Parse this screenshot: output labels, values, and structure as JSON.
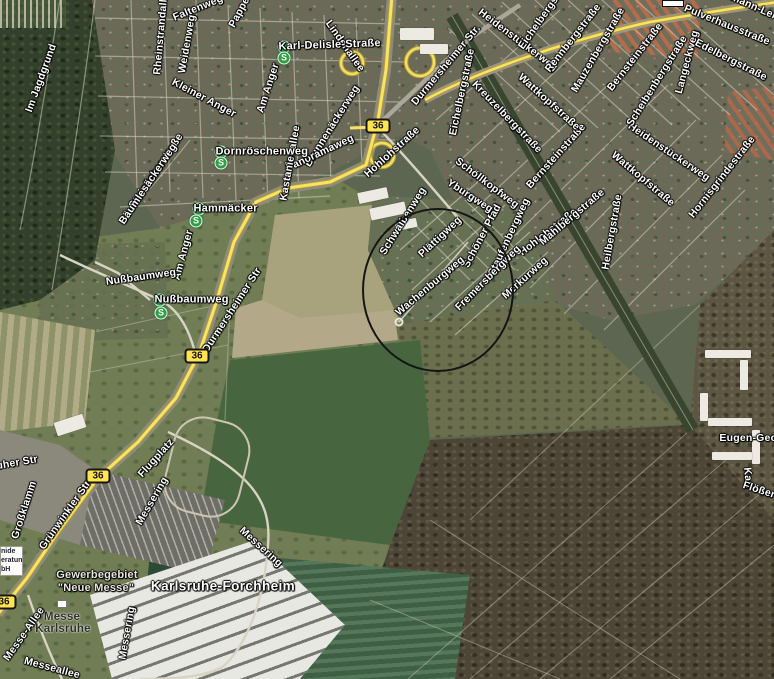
{
  "map": {
    "view_type": "satellite",
    "town_label": "Karlsruhe-Forchheim",
    "route_badge": {
      "label": "36"
    },
    "station_icon": {
      "letter": "S",
      "color": "#2f9e41"
    },
    "accent_colors": {
      "route_yellow": "#f6e468",
      "annotation_black": "#151515",
      "label_white": "#ffffff"
    }
  },
  "labels": [
    {
      "t": "Im Jagdgrund",
      "x": 41,
      "y": 78,
      "r": -70
    },
    {
      "t": "Rheinstrandallee",
      "x": 161,
      "y": 31,
      "r": -85
    },
    {
      "t": "Faltenweg",
      "x": 198,
      "y": 8,
      "r": -22
    },
    {
      "t": "Weidenweg",
      "x": 187,
      "y": 44,
      "r": -80
    },
    {
      "t": "Pappel",
      "x": 240,
      "y": 11,
      "r": -62
    },
    {
      "t": "Karl-Delisle-Straße",
      "x": 284,
      "y": 47,
      "r": -2,
      "s": "station"
    },
    {
      "t": "Lindenallee",
      "x": 345,
      "y": 46,
      "r": 55
    },
    {
      "t": "Kleiner Anger",
      "x": 204,
      "y": 98,
      "r": 28
    },
    {
      "t": "Dornröschenweg",
      "x": 221,
      "y": 152,
      "r": 0,
      "s": "station"
    },
    {
      "t": "Steinäckerstraße",
      "x": 156,
      "y": 171,
      "r": -56
    },
    {
      "t": "Bäumlesäckerweg",
      "x": 148,
      "y": 184,
      "r": -56
    },
    {
      "t": "Am Anger",
      "x": 268,
      "y": 88,
      "r": -72
    },
    {
      "t": "Brunnenäckerweg",
      "x": 332,
      "y": 126,
      "r": -58
    },
    {
      "t": "Panoramaweg",
      "x": 320,
      "y": 153,
      "r": -25
    },
    {
      "t": "Kastanienallee",
      "x": 290,
      "y": 163,
      "r": -80
    },
    {
      "t": "Hammäcker",
      "x": 199,
      "y": 209,
      "r": 0,
      "s": "station"
    },
    {
      "t": "Am Anger",
      "x": 183,
      "y": 255,
      "r": -75
    },
    {
      "t": "Nußbaumweg",
      "x": 141,
      "y": 277,
      "r": -8
    },
    {
      "t": "Nußbaumweg",
      "x": 160,
      "y": 300,
      "r": 0,
      "s": "station"
    },
    {
      "t": "Durmersheimer Str.",
      "x": 446,
      "y": 65,
      "r": -50
    },
    {
      "t": "Durmersheimer Str",
      "x": 232,
      "y": 310,
      "r": -57
    },
    {
      "t": "Hohlohstraße",
      "x": 392,
      "y": 152,
      "r": -42
    },
    {
      "t": "Hohlohstraße",
      "x": 548,
      "y": 232,
      "r": -38
    },
    {
      "t": "Heidenstückerweg",
      "x": 518,
      "y": 40,
      "r": 37
    },
    {
      "t": "Heidenstückerweg",
      "x": 669,
      "y": 152,
      "r": 34
    },
    {
      "t": "Eichelbergstraße",
      "x": 546,
      "y": 12,
      "r": -55
    },
    {
      "t": "Eichelbergstraße",
      "x": 462,
      "y": 92,
      "r": -78
    },
    {
      "t": "Kreuzelbergstraße",
      "x": 507,
      "y": 117,
      "r": 46
    },
    {
      "t": "Rennbergstraße",
      "x": 573,
      "y": 38,
      "r": -52
    },
    {
      "t": "Mauzenbergstraße",
      "x": 598,
      "y": 50,
      "r": -60
    },
    {
      "t": "Bernsteinstraße",
      "x": 635,
      "y": 57,
      "r": -52
    },
    {
      "t": "Bernsteinstraße",
      "x": 556,
      "y": 156,
      "r": -48
    },
    {
      "t": "Scheibenbergstraße",
      "x": 657,
      "y": 81,
      "r": -58
    },
    {
      "t": "Langeckweg",
      "x": 687,
      "y": 62,
      "r": -75
    },
    {
      "t": "Edelbergstraße",
      "x": 731,
      "y": 60,
      "r": 27
    },
    {
      "t": "Pulverhausstraße",
      "x": 727,
      "y": 25,
      "r": 22
    },
    {
      "t": "rmann-Leich",
      "x": 757,
      "y": 8,
      "r": 24
    },
    {
      "t": "Wattkopfstraße",
      "x": 549,
      "y": 102,
      "r": 42
    },
    {
      "t": "Wattkopfstraße",
      "x": 643,
      "y": 179,
      "r": 40
    },
    {
      "t": "Mahlbergstraße",
      "x": 572,
      "y": 217,
      "r": -40
    },
    {
      "t": "Heilbergstraße",
      "x": 612,
      "y": 232,
      "r": -80
    },
    {
      "t": "Hornisgrindestraße",
      "x": 722,
      "y": 177,
      "r": -52
    },
    {
      "t": "Schwalbenweg",
      "x": 403,
      "y": 221,
      "r": -58
    },
    {
      "t": "Schöllkopfweg",
      "x": 487,
      "y": 183,
      "r": 37
    },
    {
      "t": "Yburgweg",
      "x": 470,
      "y": 196,
      "r": 33
    },
    {
      "t": "Plättigweg",
      "x": 440,
      "y": 237,
      "r": -43
    },
    {
      "t": "Schöner Pfad",
      "x": 482,
      "y": 236,
      "r": -62
    },
    {
      "t": "Staufenbergweg",
      "x": 509,
      "y": 237,
      "r": -65
    },
    {
      "t": "Wachenburgweg",
      "x": 430,
      "y": 286,
      "r": -40
    },
    {
      "t": "Fremersbergweg",
      "x": 488,
      "y": 278,
      "r": -45
    },
    {
      "t": "Merkurweg",
      "x": 525,
      "y": 278,
      "r": -42
    },
    {
      "t": "Flugplatz",
      "x": 156,
      "y": 458,
      "r": -48
    },
    {
      "t": "Messering",
      "x": 152,
      "y": 501,
      "r": -60
    },
    {
      "t": "Messering",
      "x": 127,
      "y": 633,
      "r": -80
    },
    {
      "t": "Messering",
      "x": 261,
      "y": 547,
      "r": 42
    },
    {
      "t": "Grünwinkler Str",
      "x": 65,
      "y": 515,
      "r": -55
    },
    {
      "t": "Großklamm",
      "x": 24,
      "y": 510,
      "r": -72
    },
    {
      "t": "ruher Str",
      "x": 15,
      "y": 463,
      "r": -10
    },
    {
      "t": "Karlsruhe-Forchheim",
      "x": 223,
      "y": 586,
      "r": 0,
      "s": "town"
    },
    {
      "t": "Gewerbegebiet",
      "x": 97,
      "y": 575,
      "r": 0,
      "s": "district"
    },
    {
      "t": "\"Neue Messe\"",
      "x": 96,
      "y": 588,
      "r": 0,
      "s": "district"
    },
    {
      "t": "Messe",
      "x": 62,
      "y": 617,
      "r": 0,
      "s": "dark"
    },
    {
      "t": "Karlsruhe",
      "x": 63,
      "y": 629,
      "r": 0,
      "s": "dark"
    },
    {
      "t": "Messe-Allee",
      "x": 24,
      "y": 634,
      "r": -55
    },
    {
      "t": "Messeallee",
      "x": 52,
      "y": 668,
      "r": 15
    },
    {
      "t": "Eugen-Gec",
      "x": 748,
      "y": 438,
      "r": 0
    },
    {
      "t": "Karl",
      "x": 748,
      "y": 478,
      "r": 85
    },
    {
      "t": "Flößer",
      "x": 759,
      "y": 490,
      "r": 18
    }
  ],
  "stations": [
    {
      "x": 284,
      "y": 58
    },
    {
      "x": 221,
      "y": 163
    },
    {
      "x": 196,
      "y": 221
    },
    {
      "x": 161,
      "y": 313
    }
  ],
  "route_badges": [
    {
      "x": 378,
      "y": 126
    },
    {
      "x": 197,
      "y": 356
    },
    {
      "x": 98,
      "y": 476
    },
    {
      "x": 4,
      "y": 602
    }
  ],
  "business_box": {
    "lines": [
      "nide",
      "eratung",
      "bH"
    ]
  },
  "annotation": {
    "shape": "ellipse",
    "cx": 438,
    "cy": 290,
    "rx": 76,
    "ry": 82
  },
  "street_marker": {
    "x": 399,
    "y": 322
  }
}
